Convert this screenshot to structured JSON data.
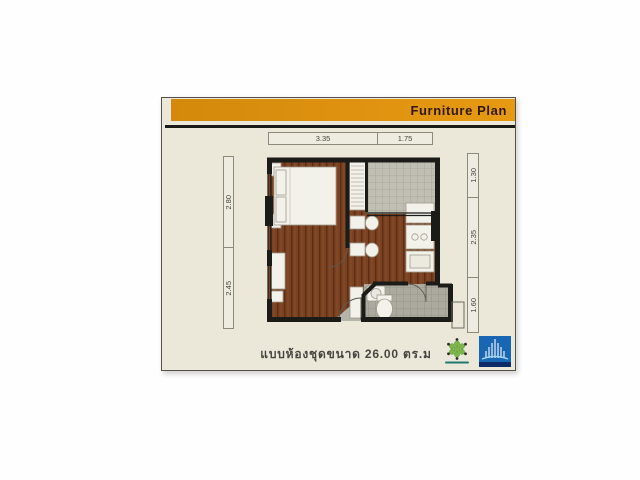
{
  "header": {
    "title": "Furniture Plan"
  },
  "dimensions": {
    "top": [
      "3.35",
      "1.75"
    ],
    "left": [
      "2.80",
      "2.45"
    ],
    "right": [
      "1.30",
      "2.35",
      "1.60"
    ]
  },
  "caption": {
    "text": "แบบห้องชุดขนาด 26.00 ตร.ม"
  },
  "icons": {
    "green_logo": "flower-molecule-emblem",
    "blue_logo": "skyscraper-building-mark"
  },
  "colors": {
    "header_bar": "#e0930f",
    "card_background": "#ebe8da",
    "wall": "#1b1b18",
    "wood_floor": "#7a4222",
    "balcony_tile": "#c0bfb4",
    "bathroom_tile": "#abaa9f",
    "blue_logo_fill": "#1966b3",
    "green_logo_fill": "#7ab648"
  }
}
